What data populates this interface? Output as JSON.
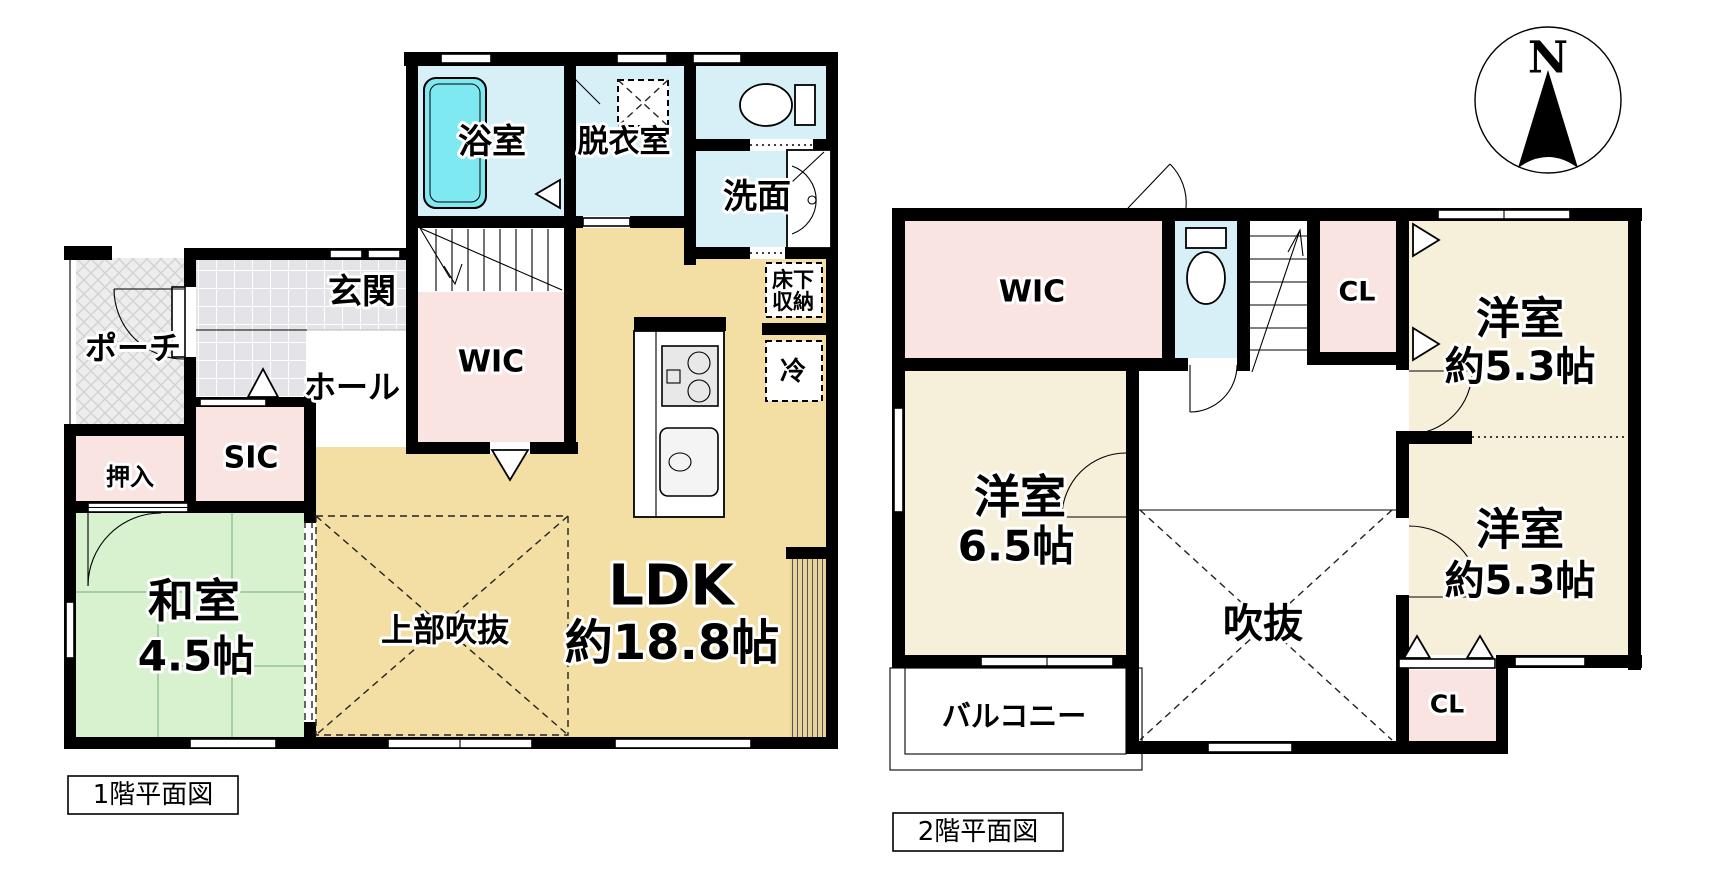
{
  "compass": {
    "north_label": "N"
  },
  "colors": {
    "water": "#d7eff7",
    "tub": "#7fe9f2",
    "pink": "#f9e4e2",
    "tan": "#f3dfa4",
    "green": "#d8f2d0",
    "cream": "#f6efd9",
    "tile": "#e4e4e8",
    "porch": "#ededed",
    "wall": "#000000"
  },
  "floor1": {
    "caption": "1階平面図",
    "labels": {
      "bath": "浴室",
      "dressing": "脱衣室",
      "washstand": "洗面",
      "porch": "ポーチ",
      "entrance": "玄関",
      "hall": "ホール",
      "wic": "WIC",
      "sic": "SIC",
      "oshiire": "押入",
      "washitsu": "和室",
      "washitsu_size": "4.5帖",
      "void_above": "上部吹抜",
      "ldk": "LDK",
      "ldk_size": "約18.8帖",
      "underfloor_1": "床下",
      "underfloor_2": "収納",
      "fridge": "冷"
    }
  },
  "floor2": {
    "caption": "2階平面図",
    "labels": {
      "wic": "WIC",
      "cl_top": "CL",
      "bedroom1": "洋室",
      "bedroom1_size": "約5.3帖",
      "bedroom2": "洋室",
      "bedroom2_size": "約5.3帖",
      "bedroom3": "洋室",
      "bedroom3_size": "6.5帖",
      "void": "吹抜",
      "balcony": "バルコニー",
      "cl_bottom": "CL"
    }
  }
}
